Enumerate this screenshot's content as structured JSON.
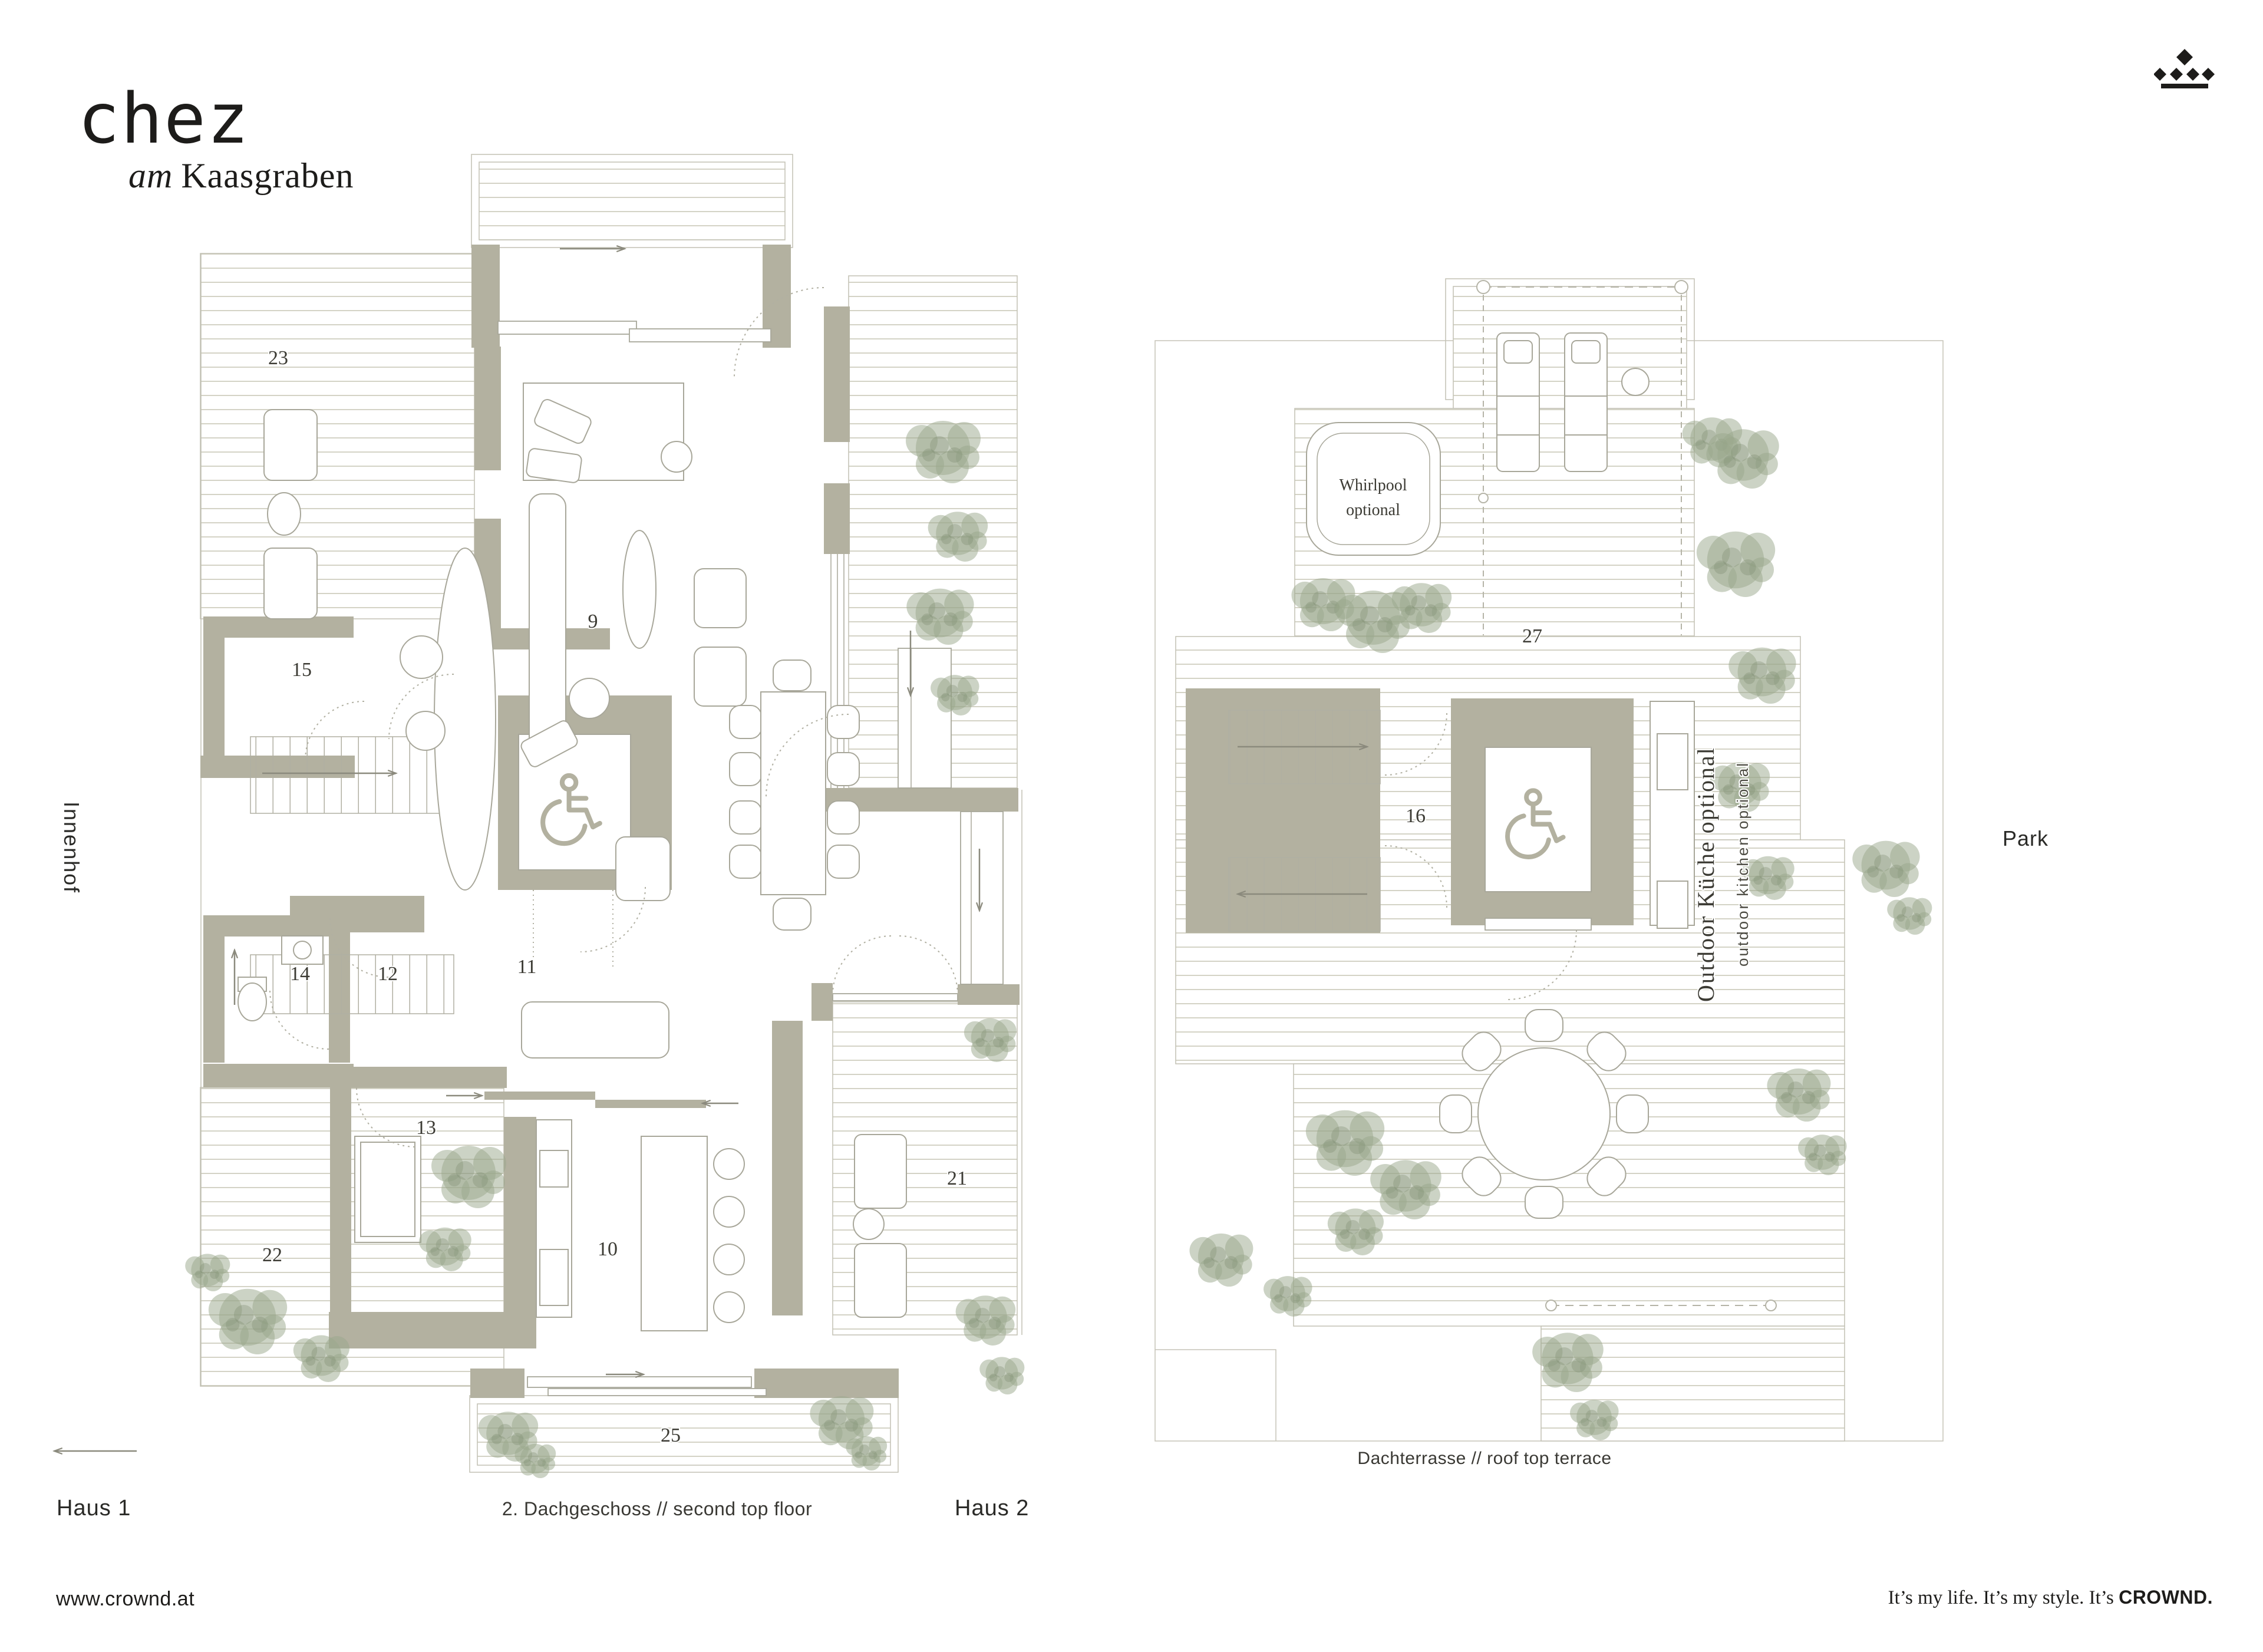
{
  "colors": {
    "wall": "#b3b1a0",
    "furniture_line": "#a8a79a",
    "deck_line": "#d4d3c6",
    "tree": "#9aa78c",
    "ink": "#1d1c1a",
    "label": "#3c3b34"
  },
  "brand": {
    "logo": "chez",
    "sub_prefix": "am",
    "sub_name": "Kaasgraben"
  },
  "side_labels": {
    "innenhof": "Innenhof",
    "park": "Park"
  },
  "captions": {
    "haus1": "Haus 1",
    "haus2": "Haus 2",
    "left_plan": "2. Dachgeschoss // second top floor",
    "right_plan": "Dachterrasse // roof top terrace"
  },
  "footer": {
    "website": "www.crownd.at",
    "tagline": "It’s my life. It’s my style. It’s",
    "brand": "CROWND."
  },
  "left_plan": {
    "room_numbers": {
      "terrace_nw": "23",
      "storage": "15",
      "living": "9",
      "wc": "14",
      "dressing": "12",
      "hall": "11",
      "bedroom": "13",
      "terrace_sw": "22",
      "kitchen": "10",
      "loggia": "21",
      "balcony_south": "25"
    }
  },
  "right_plan": {
    "area_numbers": {
      "terrace": "27",
      "lobby": "16"
    },
    "whirlpool_label": [
      "Whirlpool",
      "optional"
    ],
    "outdoor_kitchen_de": "Outdoor Küche optional",
    "outdoor_kitchen_en": "outdoor kitchen optional"
  }
}
